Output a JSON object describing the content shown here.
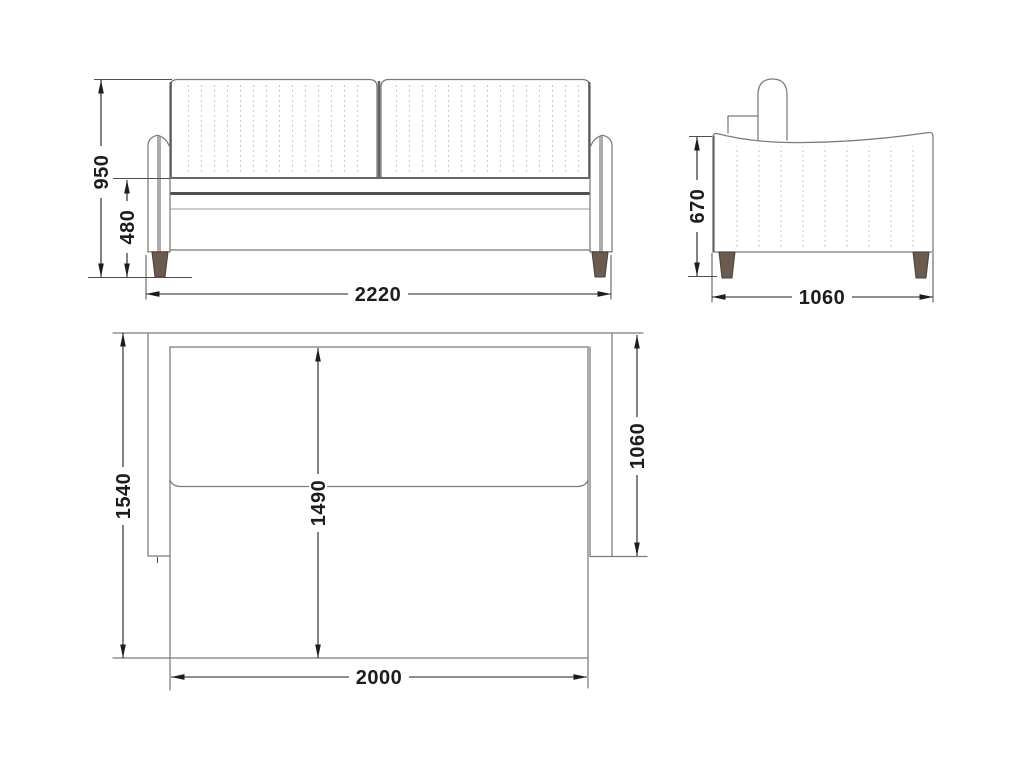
{
  "colors": {
    "line": "#7b7b7b",
    "dark_line": "#55504a",
    "dim": "#1d1d1d",
    "leg_fill": "#6a5a4f",
    "leg_stroke": "#4e4138",
    "stitch": "#c9c5c0",
    "background": "#ffffff"
  },
  "views": {
    "front": {
      "dims": {
        "overall_height": "950",
        "base_height": "480",
        "overall_width": "2220"
      }
    },
    "side": {
      "dims": {
        "arm_height": "670",
        "depth": "1060"
      }
    },
    "top": {
      "dims": {
        "unfolded_depth": "1540",
        "bed_depth": "1490",
        "frame_depth": "1060",
        "bed_length": "2000"
      }
    }
  }
}
